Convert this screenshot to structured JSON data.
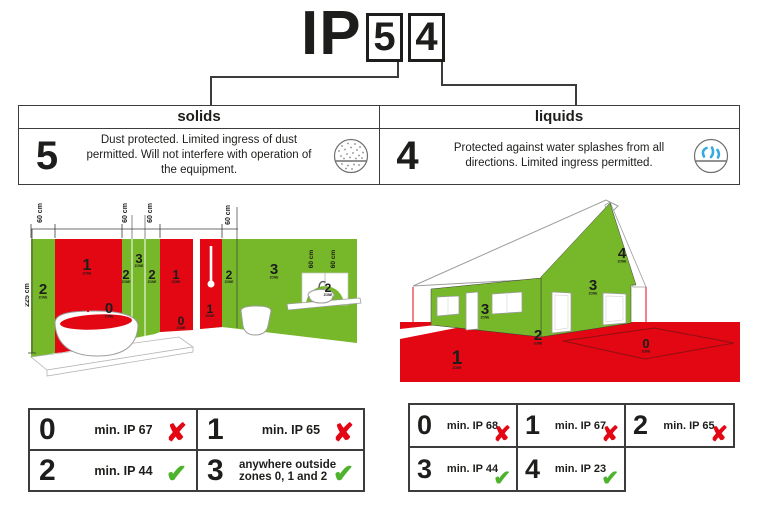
{
  "title": {
    "prefix": "IP",
    "solids_digit": "5",
    "liquids_digit": "4"
  },
  "rating_table": {
    "solids": {
      "header": "solids",
      "digit": "5",
      "description": "Dust protected. Limited ingress of dust permitted. Will not interfere with operation of the equipment.",
      "icon": "dust-protection-icon"
    },
    "liquids": {
      "header": "liquids",
      "digit": "4",
      "description": "Protected against water splashes from all directions. Limited ingress permitted.",
      "icon": "water-splash-icon"
    }
  },
  "zone_word": "ZONE",
  "bathroom": {
    "height_label": "225 cm",
    "dim_labels": [
      "60 cm",
      "60 cm",
      "60 cm",
      "60 cm",
      "60 cm",
      "60 cm"
    ],
    "zones": [
      "2",
      "1",
      "2",
      "3",
      "2",
      "1",
      "0",
      "1",
      "2",
      "3",
      "2",
      "0"
    ]
  },
  "house": {
    "zones": [
      "4",
      "3",
      "3",
      "2",
      "1",
      "0"
    ]
  },
  "bathroom_requirements": [
    {
      "zone": "0",
      "requirement": "min. IP 67",
      "mark": "✘",
      "allowed": false
    },
    {
      "zone": "1",
      "requirement": "min. IP 65",
      "mark": "✘",
      "allowed": false
    },
    {
      "zone": "2",
      "requirement": "min. IP 44",
      "mark": "✔",
      "allowed": true
    },
    {
      "zone": "3",
      "requirement": "anywhere outside zones 0, 1 and 2",
      "mark": "✔",
      "allowed": true
    }
  ],
  "house_requirements": [
    {
      "zone": "0",
      "requirement": "min. IP 68",
      "mark": "✘",
      "allowed": false
    },
    {
      "zone": "1",
      "requirement": "min. IP 67",
      "mark": "✘",
      "allowed": false
    },
    {
      "zone": "2",
      "requirement": "min. IP 65",
      "mark": "✘",
      "allowed": false
    },
    {
      "zone": "3",
      "requirement": "min. IP 44",
      "mark": "✔",
      "allowed": true
    },
    {
      "zone": "4",
      "requirement": "min. IP 23",
      "mark": "✔",
      "allowed": true
    }
  ],
  "colors": {
    "zone_red": "#e30613",
    "zone_green": "#76b82a",
    "cross_red": "#e30613",
    "check_green": "#4eb32c",
    "water_blue": "#36a9e1",
    "line_dark": "#3c3c3b"
  }
}
